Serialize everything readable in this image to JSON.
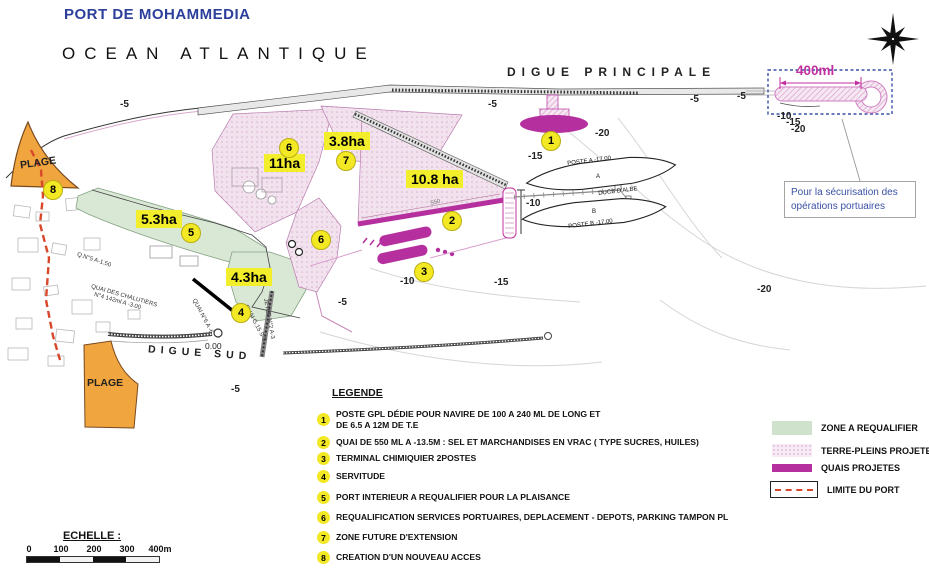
{
  "header": {
    "title": "PORT DE MOHAMMEDIA"
  },
  "map": {
    "ocean_label": "OCEAN ATLANTIQUE",
    "digue_principale_label": "DIGUE PRINCIPALE",
    "digue_sud_label": "DIGUE SUD",
    "plage_top_label": "PLAGE",
    "plage_bottom_label": "PLAGE",
    "extension_label": "400ml",
    "callout": {
      "line1": "Pour la sécurisation des",
      "line2": "opérations portuaires"
    },
    "zero_level_label": "0.00",
    "quai_length_label": "550",
    "poste_a_label": "POSTE A -17.00",
    "poste_a_letter": "A",
    "ducs_dalbe_label": "DUCS D'ALBE",
    "poste_b_letter": "B",
    "poste_b_label": "POSTE B -17.00",
    "area_labels": [
      "3.8ha",
      "11ha",
      "10.8 ha",
      "5.3ha",
      "4.3ha"
    ],
    "markers": [
      "1",
      "2",
      "3",
      "4",
      "5",
      "6",
      "6",
      "7",
      "8"
    ],
    "depth_labels": [
      "-5",
      "-5",
      "-5",
      "-5",
      "-20",
      "-15",
      "-10",
      "-10",
      "-15",
      "-20",
      "-5",
      "-5",
      "-10",
      "-15",
      "-20"
    ],
    "quai_labels": [
      "Q.N°5 A-1.50",
      "QUAI DES CHALUTIERS",
      "N°4 142ml A -3.00",
      "QUAI N°6 A -6",
      "QUAI G.15 S-3",
      "JETEE N°2 A-3"
    ]
  },
  "legend": {
    "title": "LEGENDE",
    "items": [
      {
        "num": "1",
        "line1": "POSTE GPL DÉDIE POUR NAVIRE DE 100 A 240 ML DE LONG ET",
        "line2": "DE 6.5 A 12M  DE T.E"
      },
      {
        "num": "2",
        "line1": "QUAI DE 550 ML A -13.5M : SEL ET MARCHANDISES EN VRAC ( TYPE  SUCRES, HUILES)"
      },
      {
        "num": "3",
        "line1": "TERMINAL CHIMIQUIER 2POSTES"
      },
      {
        "num": "4",
        "line1": "SERVITUDE"
      },
      {
        "num": "5",
        "line1": "PORT INTERIEUR A REQUALIFIER POUR LA PLAISANCE"
      },
      {
        "num": "6",
        "line1": "REQUALIFICATION SERVICES PORTUAIRES, DEPLACEMENT - DEPOTS, PARKING TAMPON PL"
      },
      {
        "num": "7",
        "line1": "ZONE FUTURE D'EXTENSION"
      },
      {
        "num": "8",
        "line1": "CREATION D'UN NOUVEAU ACCES"
      }
    ]
  },
  "map_key": {
    "items": [
      {
        "label": "ZONE A REQUALIFIER",
        "color": "#cfe2cc"
      },
      {
        "label": "TERRE-PLEINS PROJETES",
        "color": "#f3e2ef"
      },
      {
        "label": "QUAIS PROJETES",
        "color": "#b5309e"
      },
      {
        "label": "LIMITE DU PORT",
        "color": "#d9472b"
      }
    ]
  },
  "scale": {
    "title": "ECHELLE :",
    "ticks": [
      "0",
      "100",
      "200",
      "300",
      "400m"
    ]
  },
  "colors": {
    "title_blue": "#2b3f9b",
    "accent_magenta": "#b5309e",
    "marker_yellow": "#f2e824",
    "zone_pink": "#f2e2ee",
    "zone_green": "#d9e7d5",
    "plage_orange": "#f0a53f",
    "limit_red": "#d9472b",
    "dashed_box_blue": "#3a51a5"
  }
}
